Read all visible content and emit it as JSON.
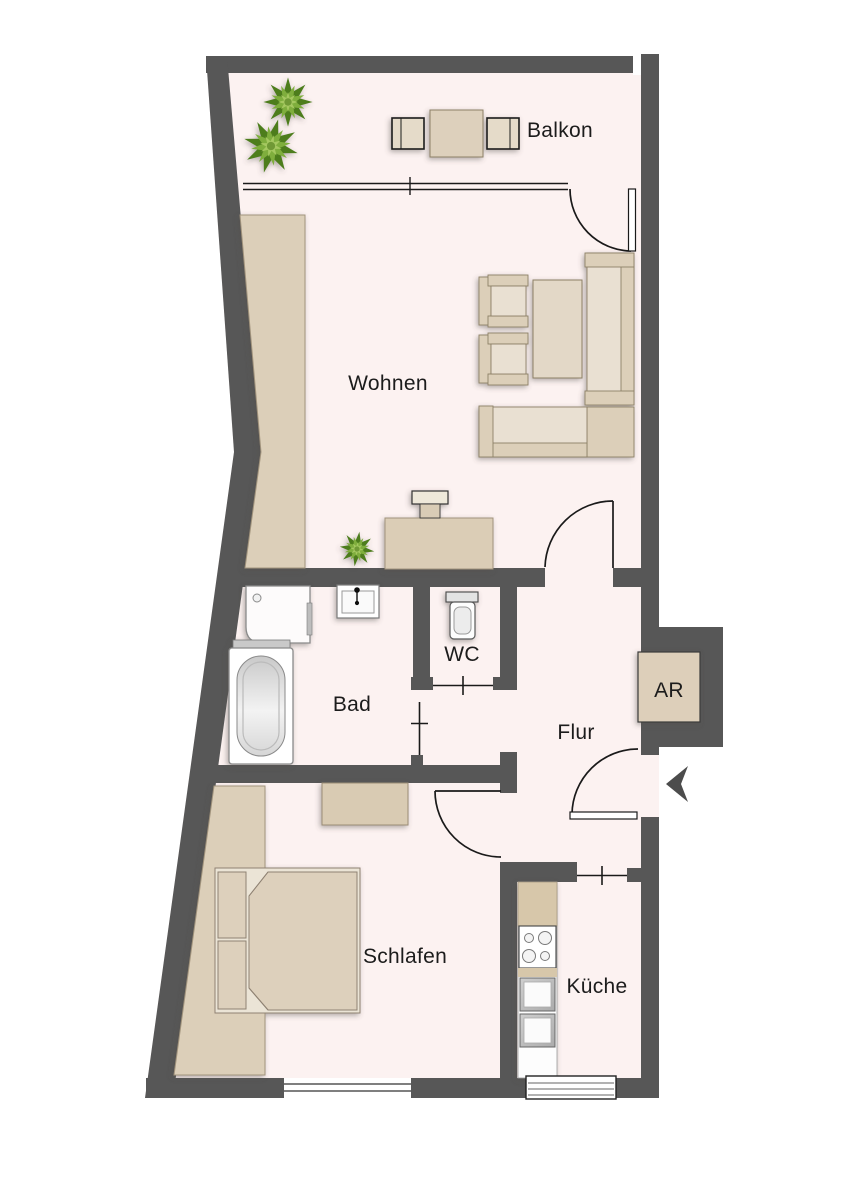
{
  "plan": {
    "type": "apartment-floorplan",
    "rooms": [
      {
        "id": "balkon",
        "label": "Balkon"
      },
      {
        "id": "wohnen",
        "label": "Wohnen"
      },
      {
        "id": "bad",
        "label": "Bad"
      },
      {
        "id": "wc",
        "label": "WC"
      },
      {
        "id": "flur",
        "label": "Flur"
      },
      {
        "id": "ar",
        "label": "AR"
      },
      {
        "id": "schlafen",
        "label": "Schlafen"
      },
      {
        "id": "kueche",
        "label": "Küche"
      }
    ],
    "colors": {
      "wall": "#575757",
      "floor": "#fcf2f1",
      "outside": "#ffffff",
      "furniture_beige": "#dccfb9",
      "furniture_light": "#e9e0d2",
      "kitchen_counter": "#d7c7aa",
      "plant_green": "#7fae3c",
      "label_text": "#1c1c1c"
    },
    "furniture_icons": [
      {
        "id": "plant-icon",
        "count": 3
      },
      {
        "id": "balcony-table"
      },
      {
        "id": "balcony-chairs"
      },
      {
        "id": "wardrobe-living"
      },
      {
        "id": "armchairs"
      },
      {
        "id": "coffee-table"
      },
      {
        "id": "corner-sofa"
      },
      {
        "id": "tv-sideboard"
      },
      {
        "id": "shower"
      },
      {
        "id": "washbasin"
      },
      {
        "id": "bathtub"
      },
      {
        "id": "toilet"
      },
      {
        "id": "storage-box-ar"
      },
      {
        "id": "entrance-arrow-icon"
      },
      {
        "id": "wardrobe-bedroom"
      },
      {
        "id": "double-bed"
      },
      {
        "id": "dresser"
      },
      {
        "id": "kitchen-unit"
      },
      {
        "id": "stove"
      },
      {
        "id": "sink-appliances"
      }
    ]
  }
}
